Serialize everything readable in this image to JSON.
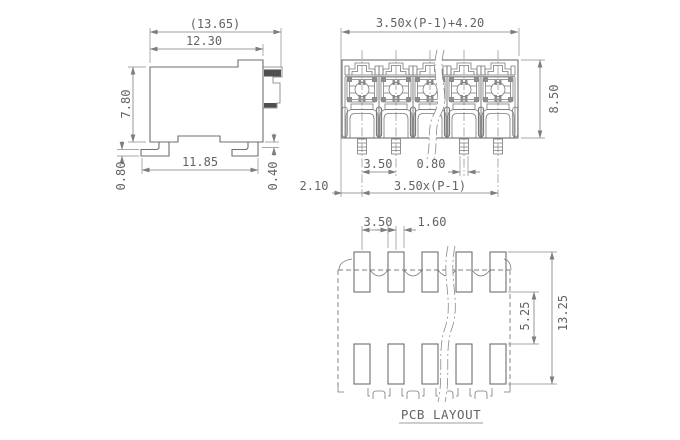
{
  "side_view": {
    "overall_width": "(13.65)",
    "body_width": "12.30",
    "body_height": "7.80",
    "foot_span": "11.85",
    "lead_thickness": "0.80",
    "standoff": "0.40"
  },
  "front_view": {
    "overall_width": "3.50x(P-1)+4.20",
    "body_height": "8.50",
    "pin_pitch": "3.50",
    "pin_width": "0.80",
    "end_offset": "2.10",
    "pin_span": "3.50x(P-1)"
  },
  "pcb_layout": {
    "pad_pitch": "3.50",
    "pad_width": "1.60",
    "row_gap": "5.25",
    "overall_height": "13.25",
    "caption": "PCB LAYOUT"
  },
  "colors": {
    "line": "#6f6f6f",
    "dimension": "#7d7d7d",
    "text": "#636363",
    "dark_fill": "#8d8d8d",
    "background": "#ffffff"
  }
}
